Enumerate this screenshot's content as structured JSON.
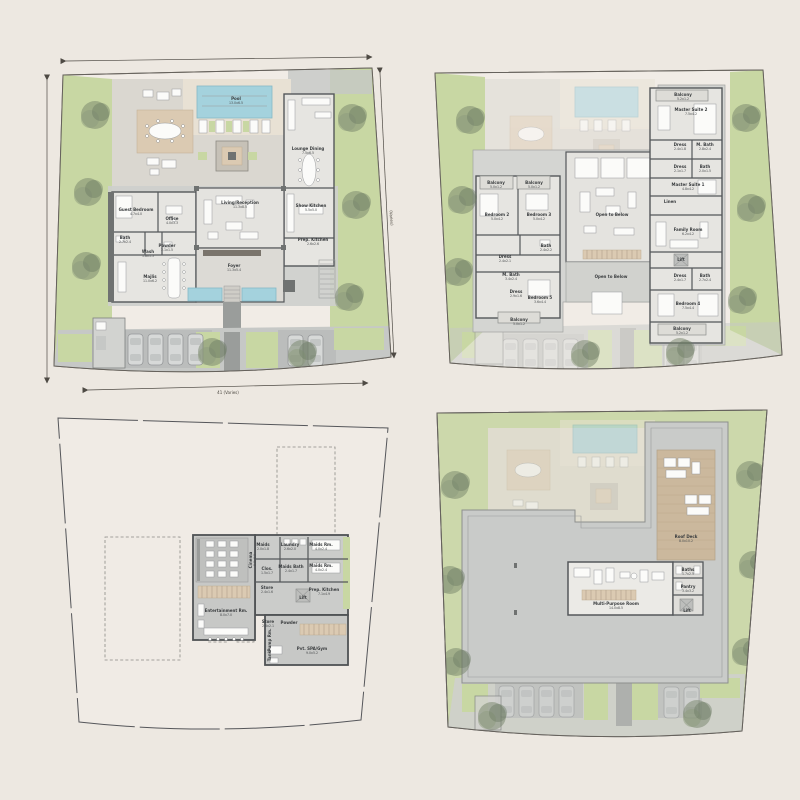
{
  "palette": {
    "background": "#EDE8E1",
    "plot_paper": "#F1ECE6",
    "landscape_green": "#C8D7A3",
    "tree_green": "#75836A",
    "pool_blue": "#A4D2DD",
    "deck_wood": "#DBCAB2",
    "roof_deck_wood": "#CBB89D",
    "paving_gray": "#DAD7D0",
    "slab_gray": "#C9CBC9",
    "wall_dark": "#54575A",
    "label_text": "#3A3D3F"
  },
  "plans": [
    {
      "id": "ground-floor",
      "dim_bottom": "41 (Varies)",
      "dim_right": "(Varies)",
      "rooms": [
        {
          "label": "Pool",
          "area": "13.0x6.5",
          "x": 236,
          "y": 100
        },
        {
          "label": "Lounge Dining",
          "area": "7.5x6.5",
          "x": 308,
          "y": 150
        },
        {
          "label": "Show Kitchen",
          "area": "5.5x5.0",
          "x": 311,
          "y": 207
        },
        {
          "label": "Prep. Kitchen",
          "area": "2.6x2.6",
          "x": 313,
          "y": 241
        },
        {
          "label": "Living/Reception",
          "area": "11.3x8.5",
          "x": 240,
          "y": 204
        },
        {
          "label": "Foyer",
          "area": "11.3x5.4",
          "x": 234,
          "y": 267
        },
        {
          "label": "Office",
          "area": "4.0x3.3",
          "x": 172,
          "y": 220
        },
        {
          "label": "Guest Bedroom",
          "area": "4.7x4.0",
          "x": 136,
          "y": 211
        },
        {
          "label": "Bath",
          "area": "2.7x2.4",
          "x": 125,
          "y": 239
        },
        {
          "label": "Powder",
          "area": "2.1x1.5",
          "x": 167,
          "y": 247
        },
        {
          "label": "Wash",
          "area": "1.8x1.5",
          "x": 148,
          "y": 253
        },
        {
          "label": "Majlis",
          "area": "11.0x6.2",
          "x": 150,
          "y": 278
        }
      ]
    },
    {
      "id": "first-floor",
      "rooms": [
        {
          "label": "Balcony",
          "area": "5.0x1.2",
          "x": 96,
          "y": 184
        },
        {
          "label": "Balcony",
          "area": "5.0x1.2",
          "x": 134,
          "y": 184
        },
        {
          "label": "Bedroom 2",
          "area": "5.0x4.2",
          "x": 97,
          "y": 216
        },
        {
          "label": "Bedroom 3",
          "area": "5.0x4.2",
          "x": 139,
          "y": 216
        },
        {
          "label": "Bath",
          "area": "2.4x2.2",
          "x": 146,
          "y": 247
        },
        {
          "label": "Dress",
          "area": "2.4x2.1",
          "x": 105,
          "y": 258
        },
        {
          "label": "M. Bath",
          "area": "3.4x2.4",
          "x": 111,
          "y": 276
        },
        {
          "label": "Dress",
          "area": "2.9x1.6",
          "x": 116,
          "y": 293
        },
        {
          "label": "Bedroom 5",
          "area": "3.6x4.4",
          "x": 140,
          "y": 299
        },
        {
          "label": "Balcony",
          "area": "5.0x1.2",
          "x": 119,
          "y": 321
        },
        {
          "label": "Open to Below",
          "x": 212,
          "y": 216
        },
        {
          "label": "Open to Below",
          "x": 211,
          "y": 278
        },
        {
          "label": "Balcony",
          "area": "5.2x1.2",
          "x": 283,
          "y": 96
        },
        {
          "label": "Master Suite 2",
          "area": "7.5x4.2",
          "x": 291,
          "y": 111
        },
        {
          "label": "Dress",
          "area": "2.4x1.8",
          "x": 280,
          "y": 146
        },
        {
          "label": "M. Bath",
          "area": "2.8x2.4",
          "x": 305,
          "y": 146
        },
        {
          "label": "Dress",
          "area": "2.1x1.7",
          "x": 280,
          "y": 168
        },
        {
          "label": "Bath",
          "area": "2.0x1.5",
          "x": 305,
          "y": 168
        },
        {
          "label": "Master Suite 1",
          "area": "4.8x4.2",
          "x": 288,
          "y": 186
        },
        {
          "label": "Linen",
          "x": 270,
          "y": 203
        },
        {
          "label": "Family Room",
          "area": "6.2x4.2",
          "x": 288,
          "y": 231
        },
        {
          "label": "Lift",
          "x": 281,
          "y": 261
        },
        {
          "label": "Dress",
          "area": "2.4x1.7",
          "x": 280,
          "y": 277
        },
        {
          "label": "Bath",
          "area": "2.7x2.4",
          "x": 305,
          "y": 277
        },
        {
          "label": "Bedroom 4",
          "area": "7.5x4.4",
          "x": 288,
          "y": 305
        },
        {
          "label": "Balcony",
          "area": "5.2x1.2",
          "x": 282,
          "y": 330
        }
      ]
    },
    {
      "id": "basement",
      "rooms": [
        {
          "label": "Cinema",
          "area": "8.0x6.0",
          "x": 252,
          "y": 160,
          "rotate": -90
        },
        {
          "label": "Maids",
          "area": "2.0x1.8",
          "x": 263,
          "y": 146
        },
        {
          "label": "Laundry",
          "area": "2.6x2.0",
          "x": 290,
          "y": 146
        },
        {
          "label": "Maids Rm.",
          "area": "4.0x2.4",
          "x": 321,
          "y": 146
        },
        {
          "label": "Maids Rm.",
          "area": "4.0x2.4",
          "x": 321,
          "y": 167
        },
        {
          "label": "Clos.",
          "area": "1.5x1.7",
          "x": 267,
          "y": 170
        },
        {
          "label": "Maids Bath",
          "area": "2.4x1.7",
          "x": 291,
          "y": 168
        },
        {
          "label": "Store",
          "area": "2.4x1.6",
          "x": 267,
          "y": 189
        },
        {
          "label": "Prep. Kitchen",
          "area": "7.1x4.9",
          "x": 324,
          "y": 191
        },
        {
          "label": "Lift",
          "x": 303,
          "y": 199
        },
        {
          "label": "Entertainment Rm.",
          "area": "8.0x7.0",
          "x": 226,
          "y": 212
        },
        {
          "label": "Store",
          "area": "2.6x2.1",
          "x": 268,
          "y": 223
        },
        {
          "label": "Powder",
          "x": 289,
          "y": 224
        },
        {
          "label": "Pvt. SPA/Gym",
          "area": "9.0x5.2",
          "x": 312,
          "y": 250
        },
        {
          "label": "Pump Rm.",
          "x": 271,
          "y": 240,
          "rotate": -90
        },
        {
          "label": "Tank",
          "x": 271,
          "y": 256,
          "rotate": -90
        }
      ]
    },
    {
      "id": "roof",
      "rooms": [
        {
          "label": "Roof Deck",
          "area": "8.0x10.2",
          "x": 286,
          "y": 138
        },
        {
          "label": "Multi-Purpose Room",
          "area": "14.0x8.5",
          "x": 216,
          "y": 205
        },
        {
          "label": "Baths",
          "area": "1.7x2.5",
          "x": 288,
          "y": 171
        },
        {
          "label": "Pantry",
          "area": "3.4x3.2",
          "x": 288,
          "y": 188
        },
        {
          "label": "Lift",
          "x": 287,
          "y": 212
        }
      ]
    }
  ]
}
